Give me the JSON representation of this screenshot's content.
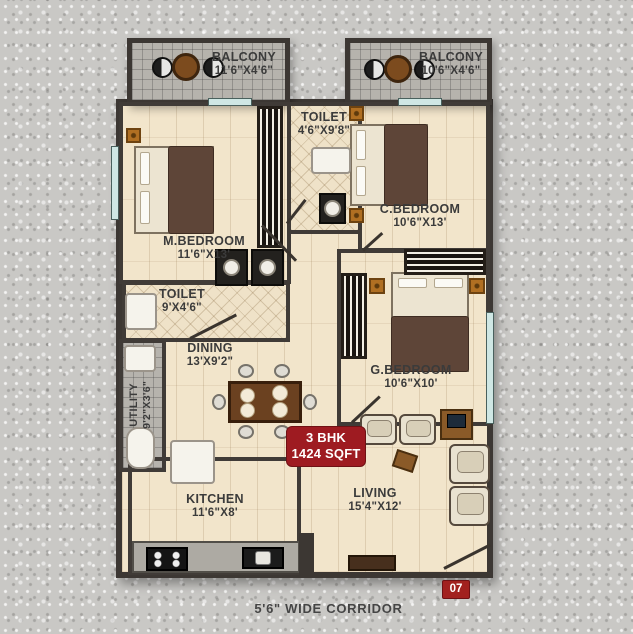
{
  "plan": {
    "rooms": [
      {
        "id": "balcony-left",
        "name": "BALCONY",
        "dims": "11'6\"X4'6\""
      },
      {
        "id": "balcony-right",
        "name": "BALCONY",
        "dims": "10'6\"X4'6\""
      },
      {
        "id": "toilet-top",
        "name": "TOILET",
        "dims": "4'6\"X9'8\""
      },
      {
        "id": "m-bedroom",
        "name": "M.BEDROOM",
        "dims": "11'6\"X13'"
      },
      {
        "id": "c-bedroom",
        "name": "C.BEDROOM",
        "dims": "10'6\"X13'"
      },
      {
        "id": "toilet-mid",
        "name": "TOILET",
        "dims": "9'X4'6\""
      },
      {
        "id": "dining",
        "name": "DINING",
        "dims": "13'X9'2\""
      },
      {
        "id": "g-bedroom",
        "name": "G.BEDROOM",
        "dims": "10'6\"X10'"
      },
      {
        "id": "utility",
        "name": "UTILITY",
        "dims": "9'2\"X3'6\""
      },
      {
        "id": "kitchen",
        "name": "KITCHEN",
        "dims": "11'6\"X8'"
      },
      {
        "id": "living",
        "name": "LIVING",
        "dims": "15'4\"X12'"
      }
    ],
    "unit_badge": {
      "line1": "3 BHK",
      "line2": "1424 SQFT"
    },
    "flat_number": "07",
    "corridor_label": "5'6\" WIDE CORRIDOR",
    "colors": {
      "badge_red": "#9E1B21",
      "wall_dark": "#3C3733",
      "floor_cream": "#F2E5CB",
      "balcony_gray": "#B6B3AD",
      "window_teal": "#CFE7E4",
      "blanket_brown": "#5E4538"
    }
  }
}
